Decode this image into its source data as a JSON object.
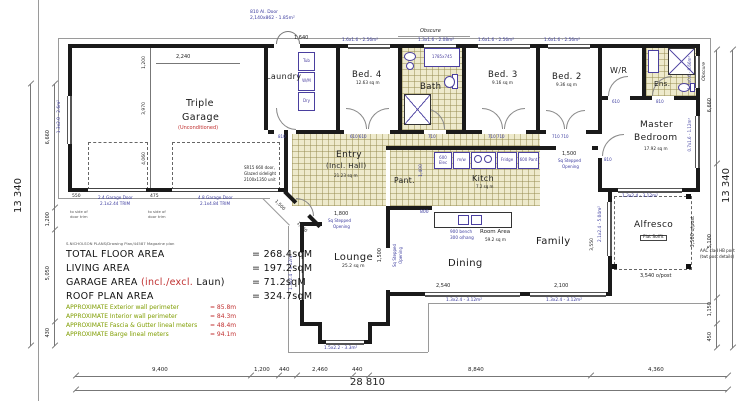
{
  "table": {
    "fine_print": "S.NICHOLSON PLANS/Drawing Plan/44587 Magazine plan",
    "rows": [
      {
        "label": "TOTAL FLOOR AREA",
        "value": "= 268.4sqM"
      },
      {
        "label": "LIVING AREA",
        "value": "= 197.2sqM"
      },
      {
        "label": "GARAGE AREA ",
        "red": "(incl./excl.",
        "label2": " Laun)",
        "value": "= 71.2sqM"
      },
      {
        "label": "ROOF PLAN AREA",
        "value": "= 324.7sqM"
      }
    ],
    "approx": [
      {
        "label": "APPROXIMATE Exterior wall perimeter",
        "value": "= 85.8m"
      },
      {
        "label": "APPROXIMATE Interior wall perimeter",
        "value": "= 84.3m"
      },
      {
        "label": "APPROXIMATE Fascia & Gutter lineal meters",
        "value": "= 48.4m"
      },
      {
        "label": "APPROXIMATE Barge lineal meters",
        "value": "= 94.1m"
      }
    ]
  },
  "rooms": {
    "garage": {
      "l1": "Triple",
      "l2": "Garage",
      "note": "(Unconditioned)"
    },
    "laundry": "Laundry",
    "bed4": {
      "name": "Bed. 4",
      "area": "12.63 sq m"
    },
    "bath": "Bath",
    "bed3": {
      "name": "Bed. 3",
      "area": "9.16 sq m"
    },
    "bed2": {
      "name": "Bed. 2",
      "area": "9.36 sq m"
    },
    "wr": "W/R",
    "ens": "Ens.",
    "master": {
      "l1": "Master",
      "l2": "Bedroom",
      "area": "17.92 sq m"
    },
    "entry": {
      "l1": "Entry",
      "l2": "(Incl. Hall)",
      "area": "21.23 sq m"
    },
    "pant": "Pant.",
    "kitch": {
      "name": "Kitch",
      "area": "7.2 sq m"
    },
    "lounge": {
      "name": "Lounge",
      "area": "25.2 sq m"
    },
    "dining": "Dining",
    "family": "Family",
    "room_area": {
      "l1": "Room Area",
      "l2": "59.2 sq m"
    },
    "alfresco": {
      "name": "Alfresco",
      "soffit": "Flat Soffit"
    }
  },
  "windows": {
    "bed4": "1.6x1.6 - 2.56m²",
    "bath": "1.3x1.6 - 2.08m²",
    "bed3": "1.6x1.6 - 2.56m²",
    "bed2": "1.6x1.6 - 2.56m²",
    "garage": "1.3x2.0 - 2.6m²",
    "lounge": "1.3x2.4 - 3.12m²",
    "bay": "1.5x2.2 - 3.3m²",
    "dining": "1.3x2.4 - 3.12m²",
    "family": "1.3x2.4 - 3.12m²",
    "master_bottom": "1.3x2.4 - 3.12m²",
    "alfresco": "2.1x2.4 - 5.04m²",
    "ens": "1.1x0.6 - 0.66m²",
    "master_right": "0.7x1.6 - 1.12m²",
    "obscure": "Obscure"
  },
  "notes": {
    "top_door1": "810 Al. Door",
    "top_door2": "2,140x862 - 1.85m²",
    "sr15_1": "SR15 660 door,",
    "sr15_2": "Glazed sidelight",
    "sr15_3": "2100x1350 unit",
    "gd1a": "2.4 Garage Door",
    "gd1b": "2.1x2.44 TRIM",
    "gd2a": "4.8 Garage Door",
    "gd2b": "2.1x4.84 TRIM",
    "trim1": "to side of",
    "trim2": "door trim",
    "aac1": "AAC clad HB post",
    "aac2": "(twt post details)"
  },
  "openings": {
    "entry": {
      "dim": "1,800",
      "l1": "Sq Stepped",
      "l2": "Opening"
    },
    "family": {
      "dim": "1,500",
      "l1": "Sq Stepped",
      "l2": "Opening"
    },
    "lounge": {
      "dim": "1,500",
      "l1": "Sq Stepped",
      "l2": "Opening"
    }
  },
  "dims": {
    "bottom": [
      "9,400",
      "1,200",
      "440",
      "2,460",
      "440",
      "8,840",
      "4,360"
    ],
    "bottom_total": "28 810",
    "left": [
      "6,660",
      "1,200",
      "5,050",
      "430"
    ],
    "left_total": "13 340",
    "right": [
      "6,660",
      "5,100",
      "1,150",
      "450"
    ],
    "right_total": "13 340",
    "g2240": "2,240",
    "g1640": "1,640",
    "g1200": "1,200",
    "g3970": "3,970",
    "g4060": "4,060",
    "g550": "550",
    "g475": "475",
    "k1400": "1,400",
    "k800": "800",
    "din2540": "2,540",
    "din2100": "2,100",
    "fam3550": "3,550",
    "alf3500": "3,500 o/post",
    "alf3540": "3,540 o/post",
    "e1500a": "1,500",
    "e1500b": "1,500"
  },
  "kitchen": {
    "elec": "600 Elec",
    "mw": "m/w",
    "fridge": "Fridge",
    "pant": "600 Pant",
    "bench": "900 bench",
    "ohang": "300 o/hang"
  },
  "laundry_fix": {
    "tub": "Tub",
    "wm": "W/M",
    "dry": "Dry"
  },
  "door_labels": {
    "bed4": "610 610",
    "bath": "710",
    "bed3": "710 710",
    "bed2": "710 710",
    "wr": "610",
    "ens": "810",
    "master": "810",
    "laundry": "810",
    "bath_tub": "1785x745"
  }
}
